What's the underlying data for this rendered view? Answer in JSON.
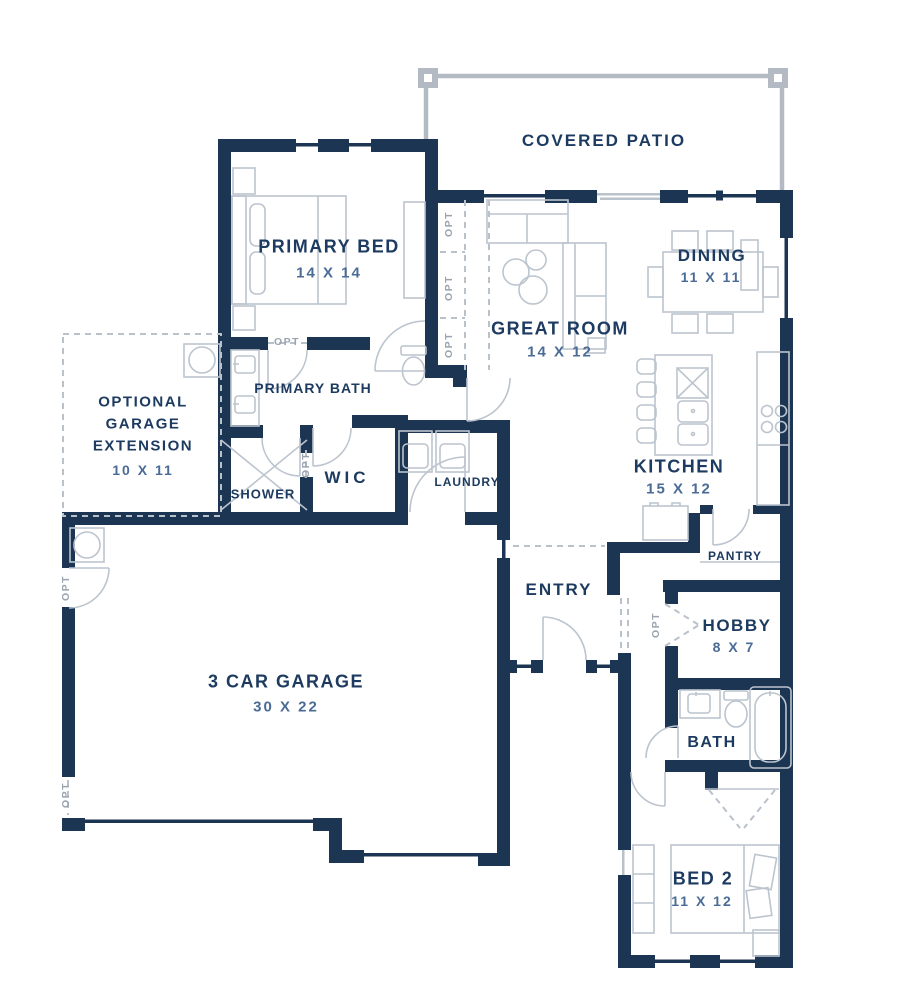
{
  "rooms": [
    {
      "id": "covered-patio",
      "label": "COVERED PATIO",
      "dims": ""
    },
    {
      "id": "primary-bed",
      "label": "PRIMARY BED",
      "dims": "14 X 14"
    },
    {
      "id": "great-room",
      "label": "GREAT ROOM",
      "dims": "14 X 12"
    },
    {
      "id": "dining",
      "label": "DINING",
      "dims": "11 X 11"
    },
    {
      "id": "kitchen",
      "label": "KITCHEN",
      "dims": "15 X 12"
    },
    {
      "id": "primary-bath",
      "label": "PRIMARY BATH",
      "dims": ""
    },
    {
      "id": "shower",
      "label": "SHOWER",
      "dims": ""
    },
    {
      "id": "wic",
      "label": "WIC",
      "dims": ""
    },
    {
      "id": "laundry",
      "label": "LAUNDRY",
      "dims": ""
    },
    {
      "id": "garage-extension",
      "label": "OPTIONAL GARAGE EXTENSION",
      "lines": [
        "OPTIONAL",
        "GARAGE",
        "EXTENSION"
      ],
      "dims": "10 X 11"
    },
    {
      "id": "garage",
      "label": "3 CAR GARAGE",
      "dims": "30 X 22"
    },
    {
      "id": "entry",
      "label": "ENTRY",
      "dims": ""
    },
    {
      "id": "pantry",
      "label": "PANTRY",
      "dims": ""
    },
    {
      "id": "hobby",
      "label": "HOBBY",
      "dims": "8 X 7"
    },
    {
      "id": "bath",
      "label": "BATH",
      "dims": ""
    },
    {
      "id": "bed2",
      "label": "BED 2",
      "dims": "11 X 12"
    }
  ],
  "opt_label": "OPT",
  "colors": {
    "wall": "#1c3553",
    "room_label": "#1d3b60",
    "dimension_text": "#4a6b95",
    "furniture_outline": "#bcc4ce",
    "optional_dashed": "#b9c1cb",
    "patio_outline": "#b3bac4",
    "background": "#ffffff"
  }
}
